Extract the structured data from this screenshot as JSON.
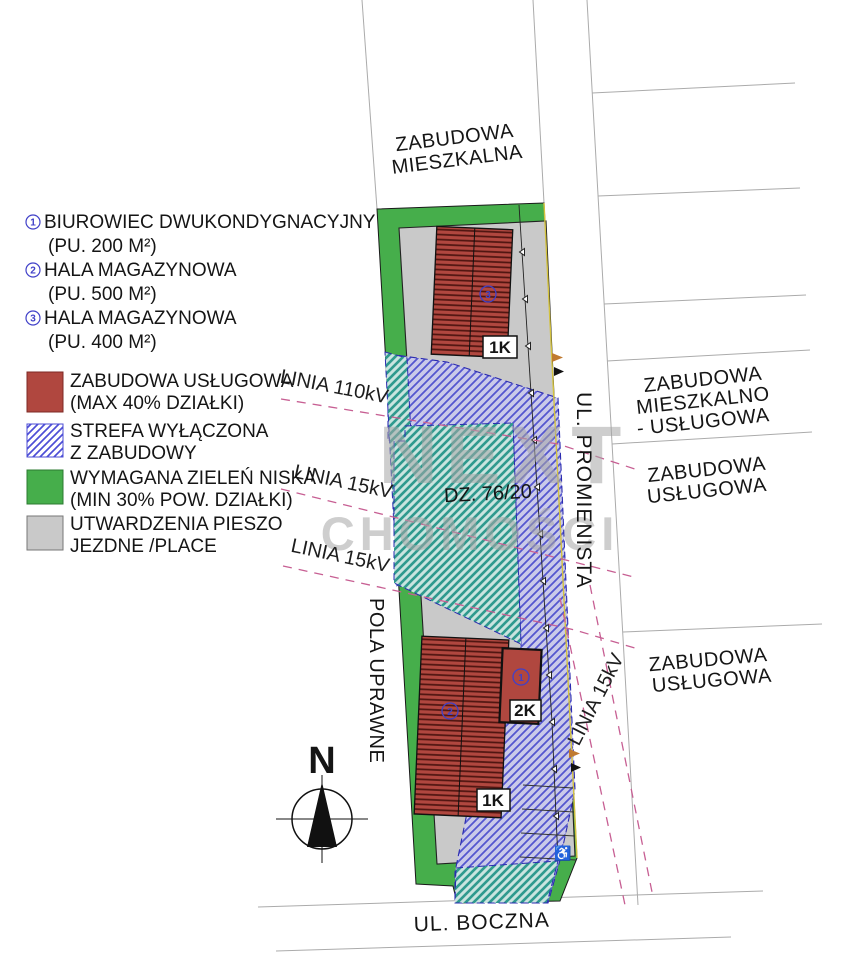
{
  "legend": {
    "buildings": [
      {
        "num": "1",
        "name": "BIUROWIEC DWUKONDYGNACYJNY",
        "area": "(PU. 200 M²)"
      },
      {
        "num": "2",
        "name": "HALA MAGAZYNOWA",
        "area": "(PU. 500 M²)"
      },
      {
        "num": "3",
        "name": "HALA MAGAZYNOWA",
        "area": "(PU. 400 M²)"
      }
    ],
    "zones": [
      {
        "l1": "ZABUDOWA USŁUGOWA",
        "l2": "(MAX 40% DZIAŁKI)"
      },
      {
        "l1": "STREFA WYŁĄCZONA",
        "l2": "Z ZABUDOWY"
      },
      {
        "l1": "WYMAGANA ZIELEŃ NISKA",
        "l2": "(MIN 30% POW. DZIAŁKI)"
      },
      {
        "l1": "UTWARDZENIA PIESZO",
        "l2": "JEZDNE /PLACE"
      }
    ]
  },
  "map": {
    "surroundings": {
      "north": [
        "ZABUDOWA",
        "MIESZKALNA"
      ],
      "east1": [
        "ZABUDOWA",
        "MIESZKALNO",
        "- USŁUGOWA"
      ],
      "east2": [
        "ZABUDOWA",
        "USŁUGOWA"
      ],
      "east3": [
        "ZABUDOWA",
        "USŁUGOWA"
      ],
      "west": "POLA UPRAWNE"
    },
    "streets": {
      "east": "UL. PROMIENISTA",
      "south": "UL. BOCZNA"
    },
    "power_lines": {
      "l110": "LINIA 110kV",
      "l15a": "LINIA 15kV",
      "l15b": "LINIA 15kV",
      "l15c": "LINIA 15kV"
    },
    "plot_number": "DZ. 76/20",
    "buildings": [
      {
        "num": "3",
        "storeys": "1K"
      },
      {
        "num": "2",
        "storeys": "1K"
      },
      {
        "num": "1",
        "storeys": "2K"
      }
    ],
    "compass": "N",
    "accessible_parking_icon": "♿"
  },
  "watermark": {
    "top": "NEXT",
    "bottom": "CHOMOŚCI"
  },
  "colors": {
    "building_fill": "#b0473f",
    "building_stripe": "#4f1510",
    "green": "#46ae4b",
    "paving": "#c9c9c9",
    "exclusion_bg": "#cacae9",
    "exclusion_stripe": "#5456cf",
    "exclusion_border": "#2b2bb0",
    "green_exclusion_bg": "#c9e4df",
    "green_exclusion_stripe": "#2f9a8e",
    "power_line": "#c75f93",
    "marker_blue": "#4040c8",
    "boundary_yellow": "#d3c23f"
  }
}
